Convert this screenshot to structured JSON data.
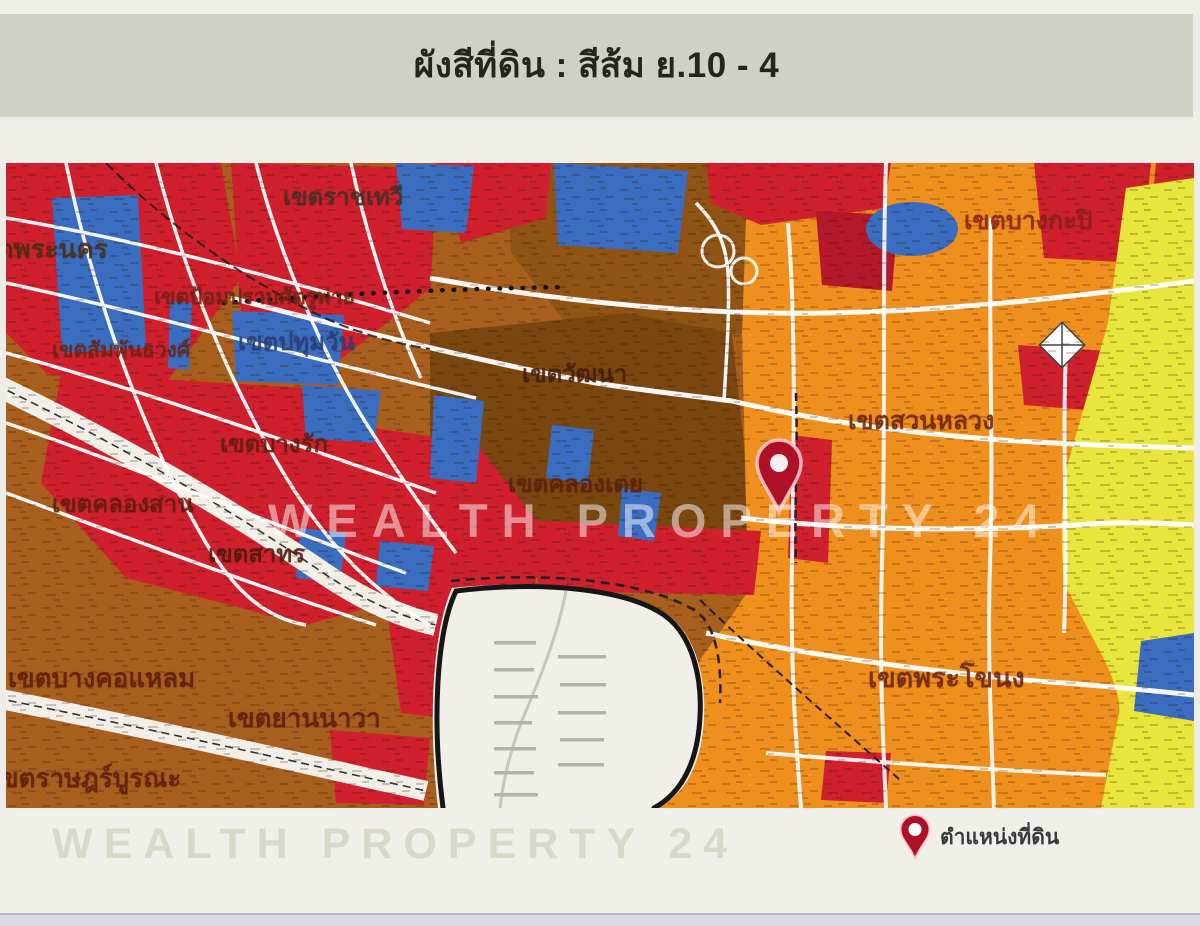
{
  "header": {
    "title": "ผังสีที่ดิน : สีส้ม ย.10 - 4"
  },
  "map": {
    "watermark": "WEALTH PROPERTY 24",
    "marker_label": "ตำแหน่งที่ดิน",
    "districts": [
      {
        "name": "เขตราชเทวี"
      },
      {
        "name": "เขตพระนคร"
      },
      {
        "name": "เขตป้อมปราบศัตรูพ่าย"
      },
      {
        "name": "เขตสัมพันธวงศ์"
      },
      {
        "name": "เขตปทุมวัน"
      },
      {
        "name": "เขตบางรัก"
      },
      {
        "name": "เขตคลองสาน"
      },
      {
        "name": "เขตสาทร"
      },
      {
        "name": "เขตวัฒนา"
      },
      {
        "name": "เขตคลองเตย"
      },
      {
        "name": "เขตสวนหลวง"
      },
      {
        "name": "เขตบางกะปิ"
      },
      {
        "name": "เขตบางคอแหลม"
      },
      {
        "name": "เขตยานนาวา"
      },
      {
        "name": "เขตราษฎร์บูรณะ"
      },
      {
        "name": "เขตพระโขนง"
      }
    ],
    "colors": {
      "residential_red": "#d0202e",
      "commerce_dark_red": "#b5182b",
      "orange": "#ef8f1d",
      "brown": "#8f5414",
      "dark_brown": "#7a4710",
      "institution_blue": "#3a6cbf",
      "industry_yellow": "#e8e63c",
      "road_white": "#ffffff",
      "outside_area_white": "#f1efe8",
      "pin_red": "#ae1126"
    }
  },
  "legend": {
    "pin_label": "ตำแหน่งที่ดิน"
  },
  "footer_watermark": "WEALTH PROPERTY 24"
}
